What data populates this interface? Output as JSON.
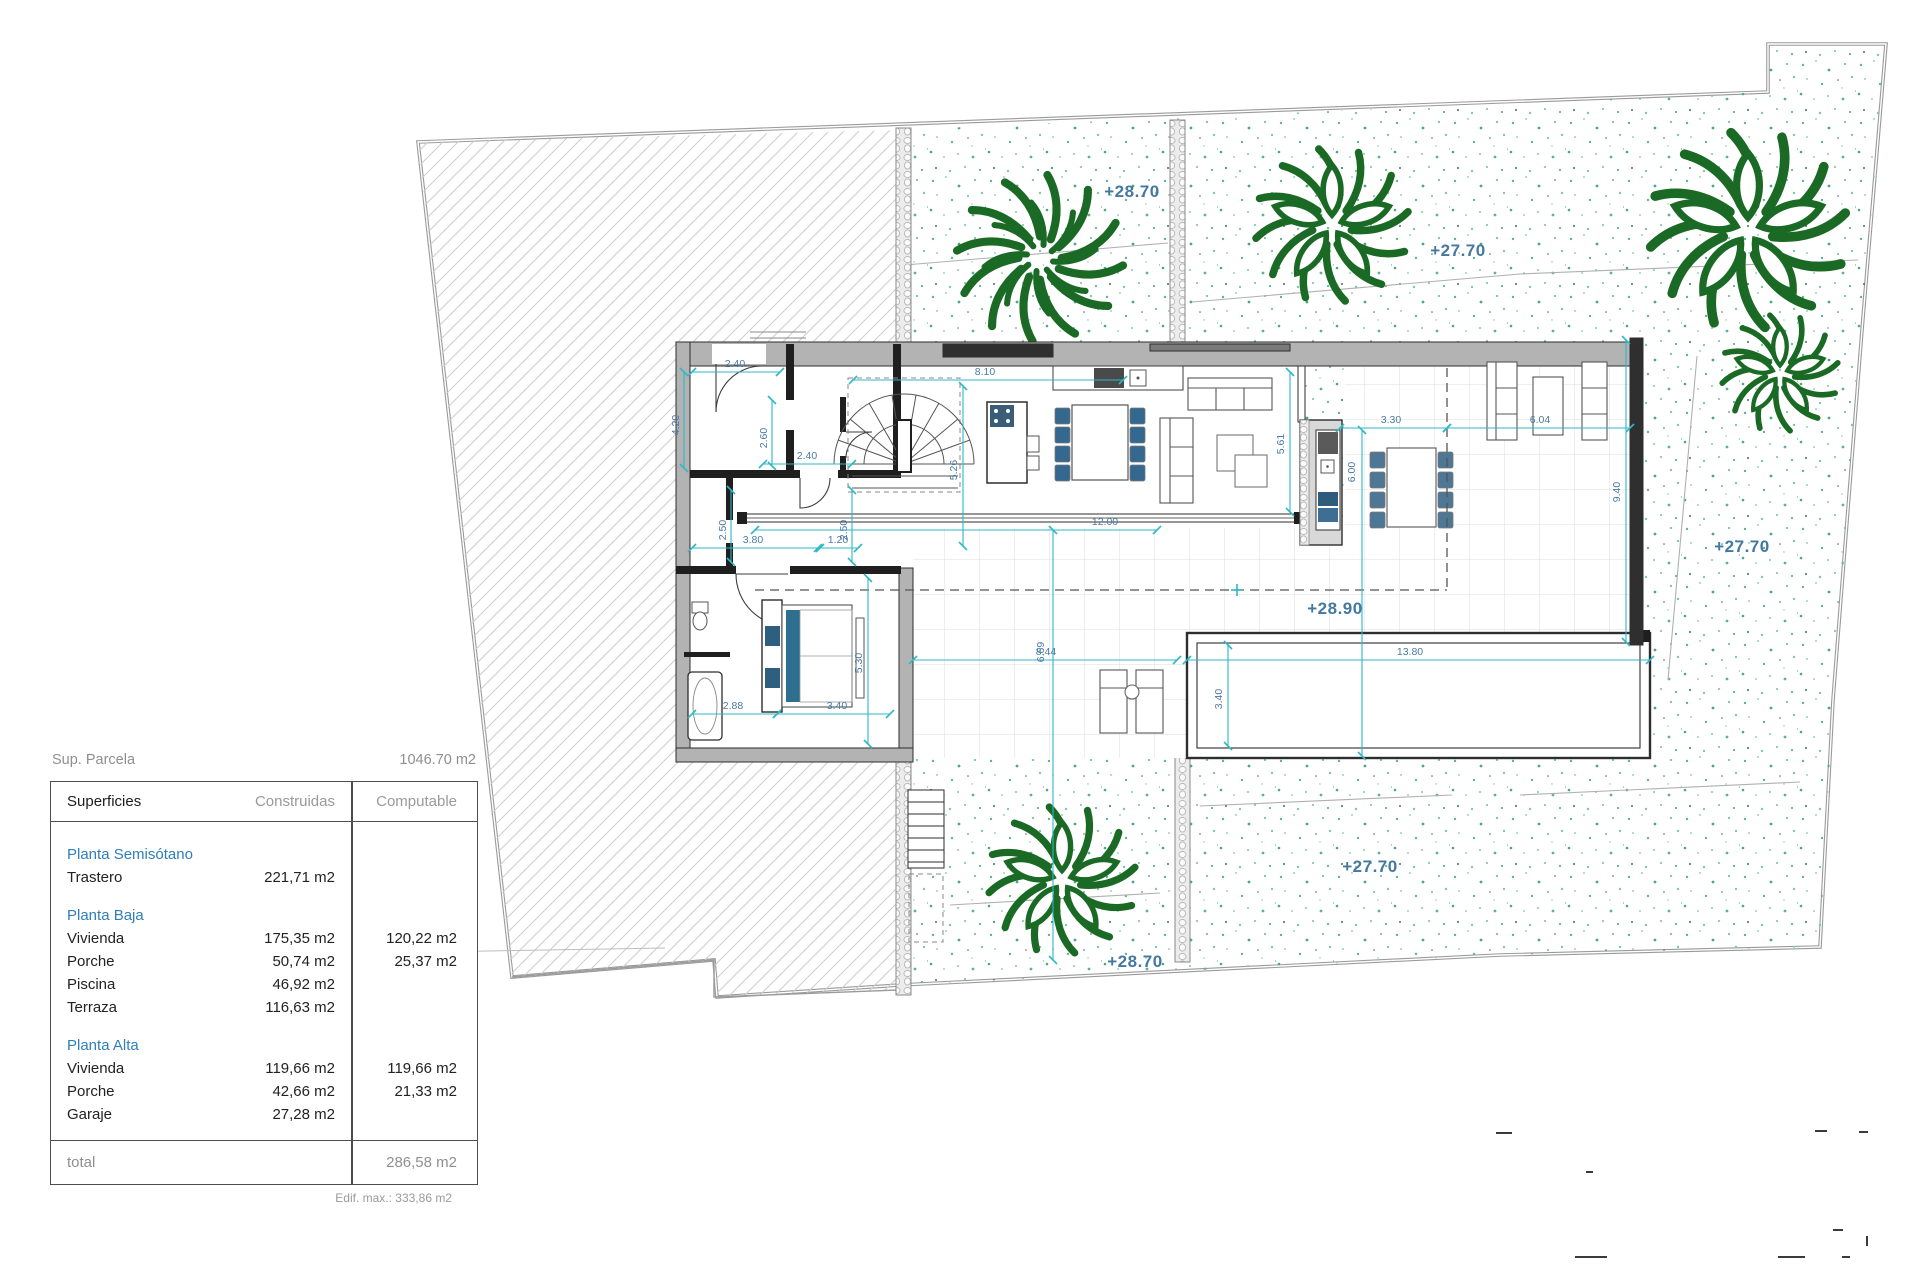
{
  "summary": {
    "label": "Sup. Parcela",
    "value": "1046.70 m2"
  },
  "table": {
    "headers": {
      "col1": "Superficies",
      "col2": "Construidas",
      "col3": "Computable"
    },
    "sections": {
      "semisotano": "Planta Semisótano",
      "baja": "Planta Baja",
      "alta": "Planta Alta"
    },
    "rows": [
      {
        "label": "Trastero",
        "construidas": "221,71 m2",
        "computable": ""
      },
      {
        "label": "Vivienda",
        "construidas": "175,35 m2",
        "computable": "120,22 m2"
      },
      {
        "label": "Porche",
        "construidas": "50,74 m2",
        "computable": "25,37 m2"
      },
      {
        "label": "Piscina",
        "construidas": "46,92 m2",
        "computable": ""
      },
      {
        "label": "Terraza",
        "construidas": "116,63 m2",
        "computable": ""
      },
      {
        "label": "Vivienda",
        "construidas": "119,66 m2",
        "computable": "119,66 m2"
      },
      {
        "label": "Porche",
        "construidas": "42,66 m2",
        "computable": "21,33 m2"
      },
      {
        "label": "Garaje",
        "construidas": "27,28 m2",
        "computable": ""
      }
    ],
    "total": {
      "label": "total",
      "value": "286,58 m2"
    },
    "footnote": "Edif. max.: 333,86 m2"
  },
  "plan": {
    "levels": {
      "lv1": "+28.70",
      "lv2": "+27.70",
      "lv3": "+27.70",
      "lv4": "+28.90",
      "lv5": "+28.70",
      "lv6": "+27.70"
    },
    "dims": {
      "a": "2.40",
      "b": "4.20",
      "c": "2.60",
      "d": "2.40",
      "e": "2.50",
      "f": "3.80",
      "g": "1.20",
      "h": "2.50",
      "i": "8.10",
      "j": "5.26",
      "k": "12.00",
      "l": "2.88",
      "m": "3.40",
      "n": "5.30",
      "o": "8.44",
      "p": "6.69",
      "q": "13.80",
      "r": "3.40",
      "s": "5.61",
      "t": "3.30",
      "u": "6.04",
      "v": "6.00",
      "w": "9.40"
    },
    "colors": {
      "dim_line": "#2fb8c6",
      "dim_text": "#4a7aa2",
      "level_text": "#44789f",
      "plant_green": "#1a6a25",
      "stipple_green": "#5fb48e",
      "wall_gray": "#b3b3b3",
      "wall_dark": "#1f1f1f",
      "boundary_gray": "#9a9a9a",
      "furniture_blue": "#35688f"
    }
  }
}
